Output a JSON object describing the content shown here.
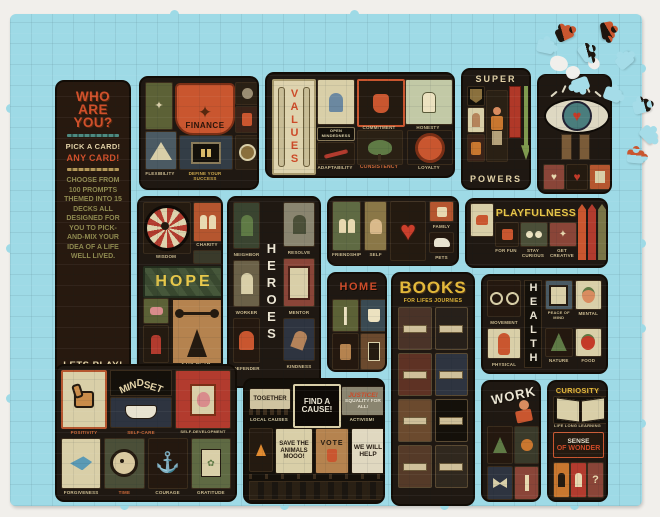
{
  "colors": {
    "mat": "#9edae6",
    "panel": "#1f1812",
    "orange": "#c9562f",
    "cream": "#e3d3a8",
    "yellow": "#e3b83a",
    "red": "#b23b2e",
    "teal": "#4a7d78",
    "olive": "#7a7547",
    "green": "#5f7a45"
  },
  "intro": {
    "title": "WHO ARE YOU?",
    "pick": "PICK A CARD!",
    "any": "ANY CARD!",
    "body": "CHOOSE FROM 100 PROMPTS THEMED INTO 15 DECKS ALL DESIGNED FOR YOU TO PICK-AND-MIX YOUR IDEA OF A LIFE WELL LIVED.",
    "cta": "LETS PLAY!"
  },
  "finance": {
    "title": "FINANCE",
    "card_flexibility": "FLEXIBILITY",
    "footer": "DEFINE YOUR SUCCESS"
  },
  "values": {
    "title": "VALUES",
    "cards": [
      "OPEN MINDEDNESS",
      "COMMITMENT",
      "HONESTY",
      "ADAPTABILITY",
      "CONSISTENCY",
      "LOYALTY"
    ]
  },
  "superpowers": {
    "title_top": "SUPER",
    "title_bottom": "POWERS"
  },
  "hope": {
    "title": "HOPE",
    "cards": [
      "WISDOM",
      "CHARITY",
      "AMBITION",
      "STRENGTH"
    ]
  },
  "heroes": {
    "title": "HEROES",
    "cards_left": [
      "NEIGHBOR",
      "WORKER",
      "DEFENDER"
    ],
    "cards_right": [
      "RESOLVE",
      "MENTOR",
      "KINDNESS"
    ]
  },
  "love": {
    "cards": [
      "FRIENDSHIP",
      "SELF",
      "FAMILY",
      "PETS"
    ]
  },
  "playfulness": {
    "title": "PLAYFULNESS",
    "cards": [
      "FOR FUN",
      "STAY CURIOUS",
      "GET CREATIVE"
    ]
  },
  "home": {
    "title": "HOME"
  },
  "books": {
    "title": "BOOKS",
    "subtitle": "FOR LIFES JOURNIES"
  },
  "health": {
    "title": "HEALTH",
    "cards": [
      "MOVEMENT",
      "PHYSICAL",
      "PEACE OF MIND",
      "MENTAL",
      "NATURE",
      "FOOD"
    ]
  },
  "mindset": {
    "title": "MINDSET",
    "cards": [
      "POSITIVITY",
      "SELF-CARE",
      "SELF-DEVELOPMENT",
      "FORGIVENESS",
      "TIME",
      "COURAGE",
      "GRATITUDE"
    ]
  },
  "activism": {
    "signs": {
      "together": "TOGETHER",
      "local": "LOCAL CAUSES",
      "find": "FIND A CAUSE!",
      "justice": "JUSTICE!",
      "equality": "EQUALITY FOR ALL!",
      "activism": "ACTIVISM!",
      "save": "SAVE THE ANIMALS MOOO!",
      "vote": "VOTE",
      "help": "WE WILL HELP"
    }
  },
  "work": {
    "title": "WORK"
  },
  "curiosity": {
    "title": "CURIOSITY",
    "subtitle": "LIFE LONG LEARNING",
    "tagline_1": "SENSE",
    "tagline_2": "OF WONDER"
  }
}
